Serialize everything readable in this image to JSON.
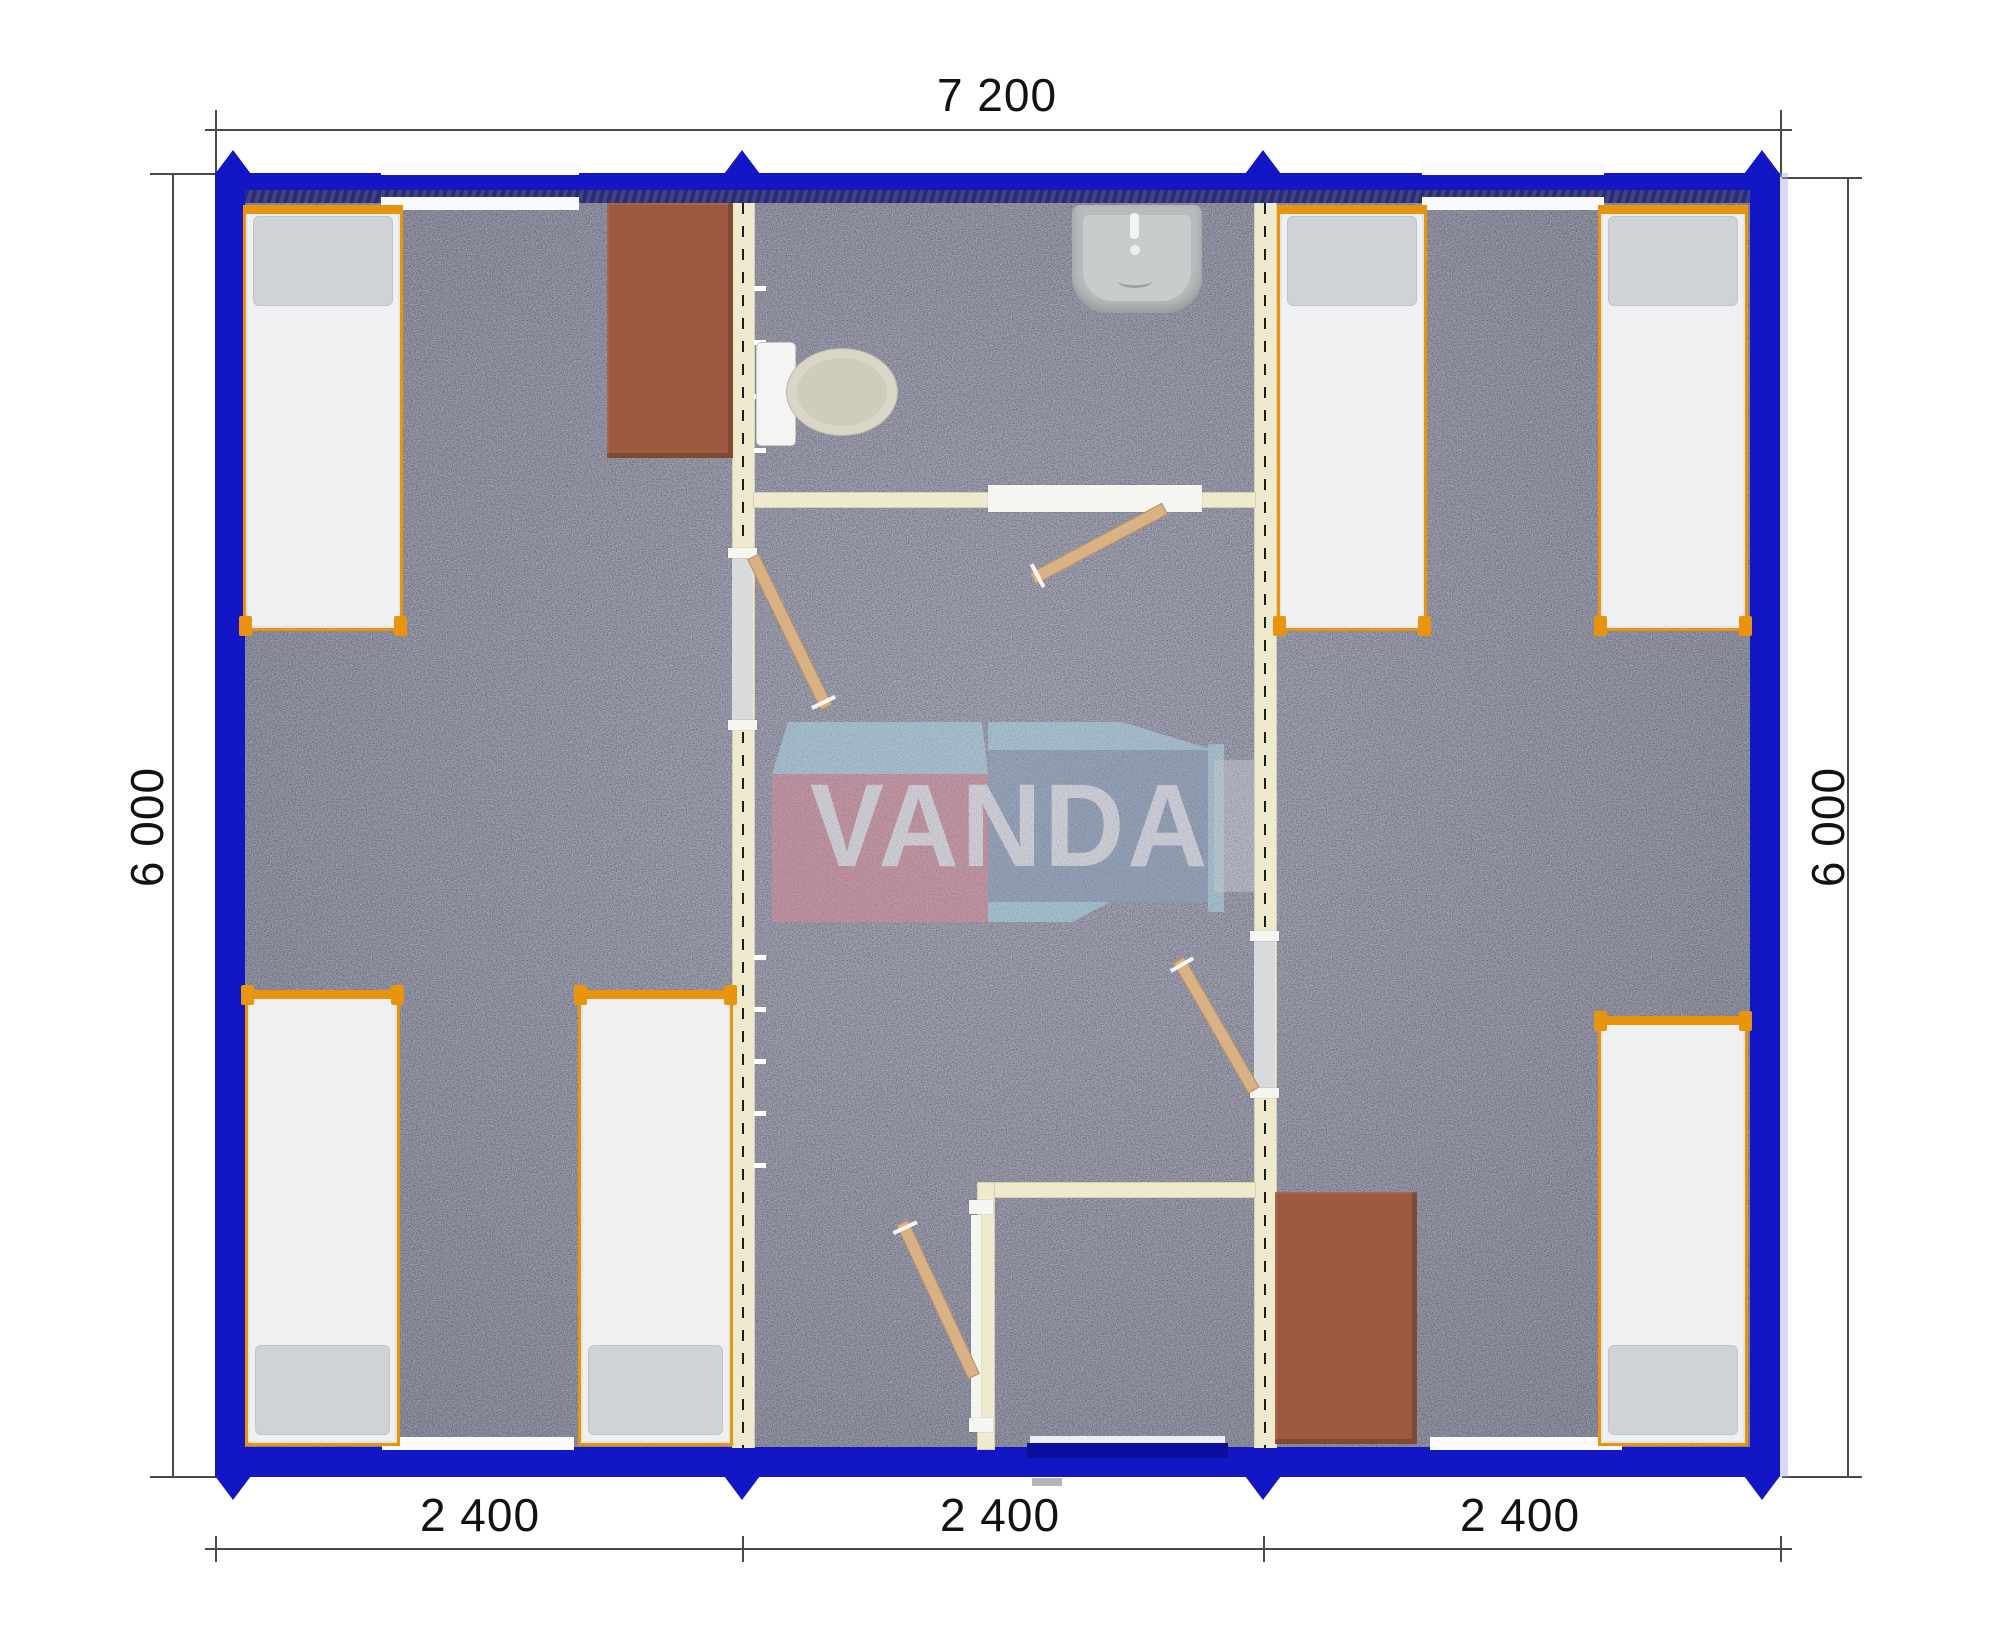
{
  "title": "Modular cabin floor plan",
  "dimensions": {
    "top": "7 200",
    "left": "6 000",
    "right": "6 000",
    "bottom_segments": [
      "2 400",
      "2 400",
      "2 400"
    ]
  },
  "watermark": {
    "text": "VANDA"
  },
  "palette": {
    "wall_blue": "#1216c4",
    "entry_door_navy": "#0c0e9e",
    "frame_orange": "#e8940c",
    "partition_cream": "#efe9ce",
    "carpet_gray": "#a4a5ac",
    "desk_brown": "#9d5940",
    "door_wood": "#d8b285",
    "logo_pink": "#dd8b94",
    "logo_steel_blue": "#8aa2bd",
    "logo_light_blue": "#aedbe8"
  },
  "fixtures": {
    "beds": 6,
    "desks": 2,
    "toilets": 1,
    "sinks": 1,
    "module_count": 3
  }
}
